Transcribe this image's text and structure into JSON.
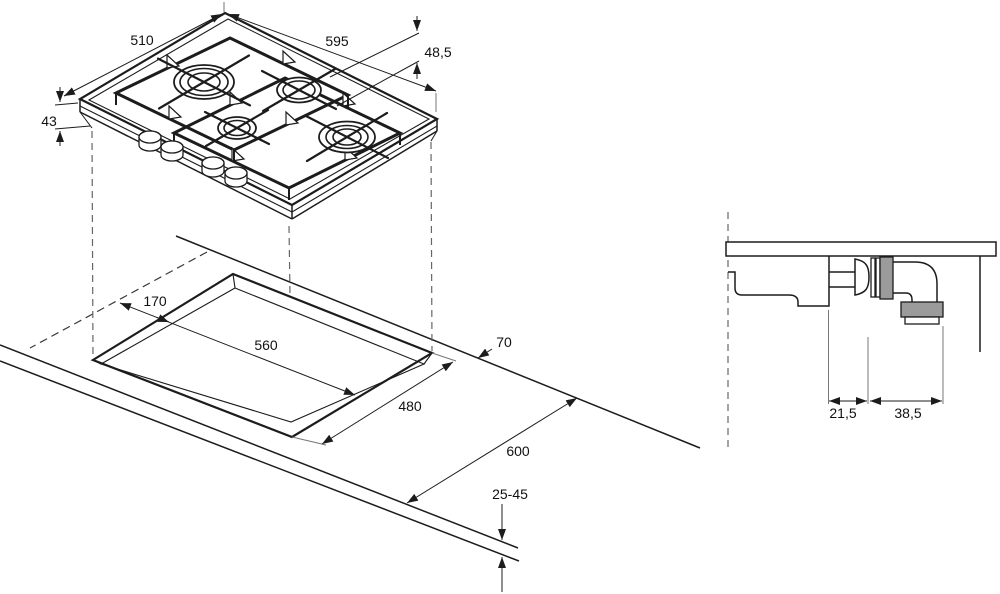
{
  "drawing": {
    "kind": "gas hob installation dimension diagram",
    "units_implied": "mm"
  },
  "hob": {
    "width": "595",
    "depth": "510",
    "profile_height": "48,5",
    "body_height": "43"
  },
  "worktop": {
    "cutout_setback": "170",
    "cutout_width": "560",
    "cutout_depth": "480",
    "rear_edge_clearance": "70",
    "worktop_depth": "600",
    "worktop_thickness": "25-45"
  },
  "connection": {
    "valve_offset": "21,5",
    "elbow_offset": "38,5"
  },
  "colors": {
    "line": "#1c1c1c",
    "fitting_gray": "#9b9b9b",
    "background": "#ffffff"
  }
}
